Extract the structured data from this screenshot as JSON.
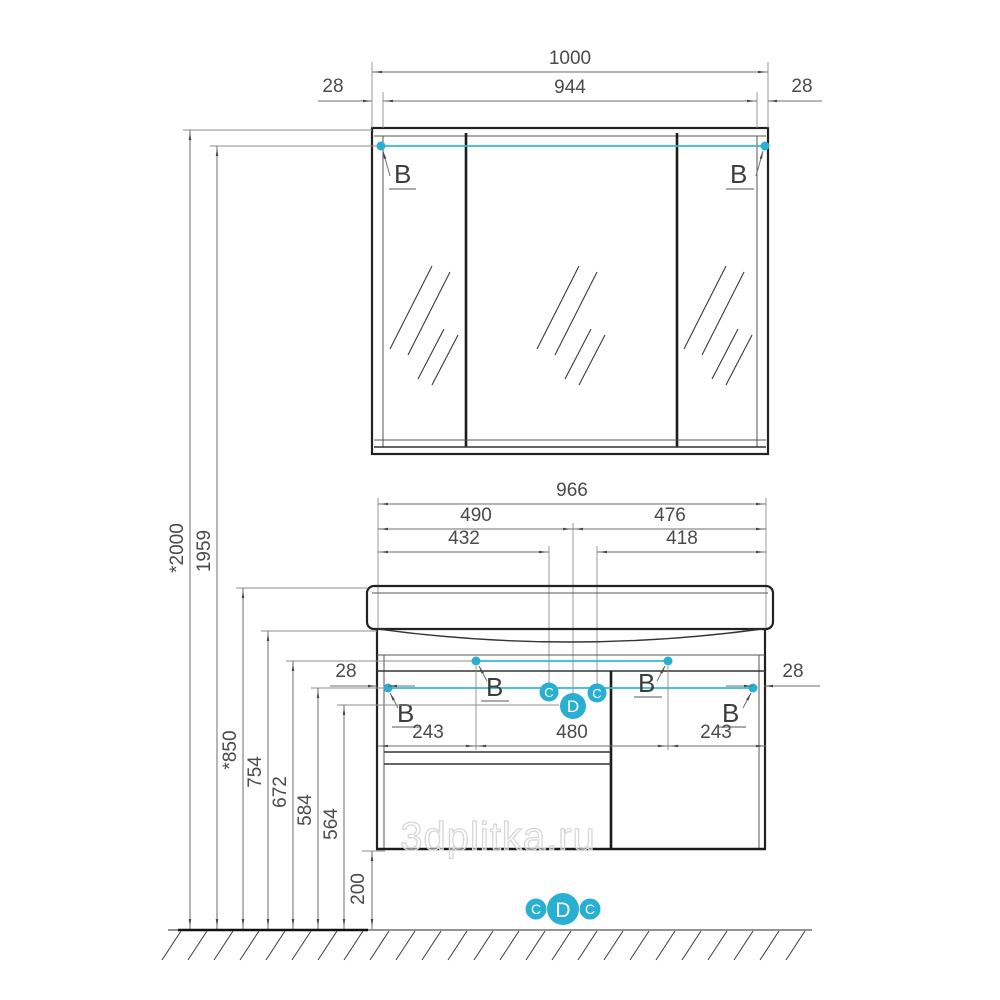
{
  "watermark": "3dplitka.ru",
  "callouts": {
    "b": "B",
    "c": "C",
    "d": "D"
  },
  "mirror_cabinet": {
    "width_total": "1000",
    "width_inner": "944",
    "wall_left": "28",
    "wall_right": "28"
  },
  "vanity": {
    "width_total": "966",
    "left_section": "490",
    "right_section": "476",
    "left_inner": "432",
    "right_inner": "418",
    "hole_left": "243",
    "hole_center": "480",
    "hole_right": "243",
    "side_left": "28",
    "side_right": "28"
  },
  "heights": {
    "overall": "*2000",
    "mirror_holes": "1959",
    "basin_top": "*850",
    "cabinet_top": "754",
    "upper_holes": "672",
    "lower_holes": "584",
    "mid_line": "564",
    "clearance": "200"
  },
  "colors": {
    "accent_cyan": "#29AFD2",
    "line_dark": "#222222",
    "dim_gray": "#6E6E6E"
  }
}
